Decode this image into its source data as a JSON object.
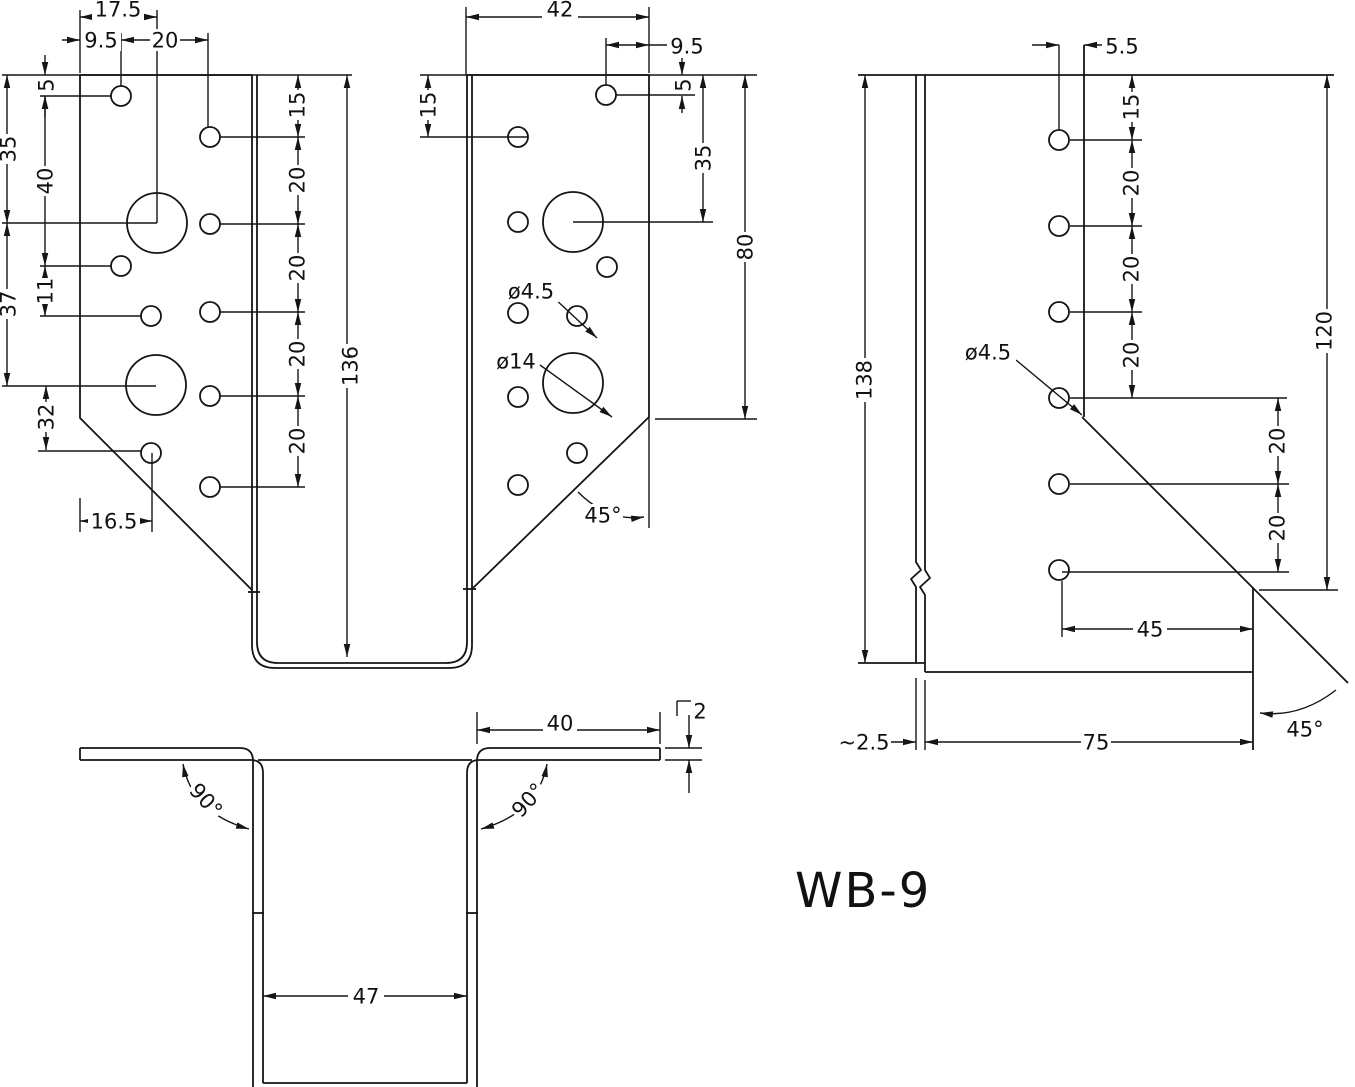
{
  "title": "WB-9",
  "front": {
    "w17_5": "17.5",
    "w9_5_left": "9.5",
    "w20_top": "20",
    "h5_left": "5",
    "h40": "40",
    "h35_left": "35",
    "h37": "37",
    "h11": "11",
    "h32": "32",
    "w16_5": "16.5",
    "h15_left": "15",
    "h20_chain": [
      "20",
      "20",
      "20",
      "20"
    ],
    "h136": "136",
    "w42": "42",
    "w9_5_right": "9.5",
    "h5_right": "5",
    "h35_right": "35",
    "h15_right": "15",
    "h80": "80",
    "dia4_5": "ø4.5",
    "dia14": "ø14",
    "angle45": "45°"
  },
  "section": {
    "w40": "40",
    "t2": "2",
    "angle90_left": "90°",
    "angle90_right": "90°",
    "w47": "47"
  },
  "side": {
    "w5_5": "5.5",
    "h15": "15",
    "h20_chain": [
      "20",
      "20",
      "20"
    ],
    "dia4_5": "ø4.5",
    "h20_chain_b": [
      "20",
      "20"
    ],
    "h138": "138",
    "h120": "120",
    "w45": "45",
    "w2_5": "~2.5",
    "w75": "75",
    "angle45": "45°"
  }
}
